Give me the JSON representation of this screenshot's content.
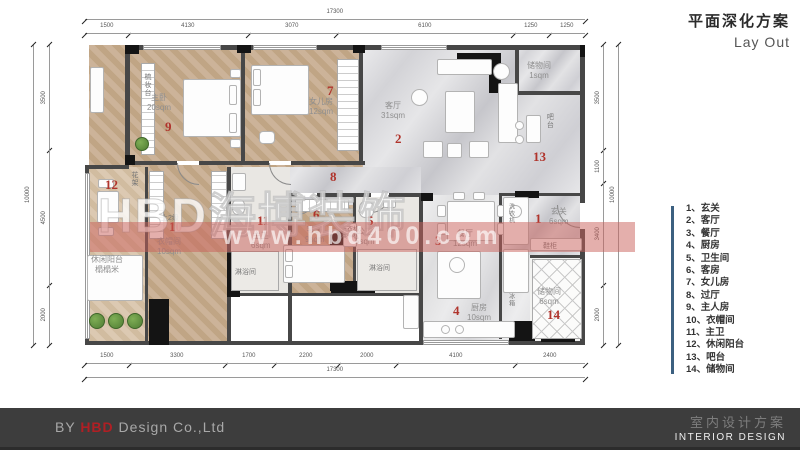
{
  "header": {
    "title_zh": "平面深化方案",
    "title_en": "Lay Out"
  },
  "legend": {
    "bar_color": "#3c6080",
    "items": [
      {
        "no": "1、",
        "label": "玄关"
      },
      {
        "no": "2、",
        "label": "客厅"
      },
      {
        "no": "3、",
        "label": "餐厅"
      },
      {
        "no": "4、",
        "label": "厨房"
      },
      {
        "no": "5、",
        "label": "卫生间"
      },
      {
        "no": "6、",
        "label": "客房"
      },
      {
        "no": "7、",
        "label": "女儿房"
      },
      {
        "no": "8、",
        "label": "过厅"
      },
      {
        "no": "9、",
        "label": "主人房"
      },
      {
        "no": "10、",
        "label": "衣帽间"
      },
      {
        "no": "11、",
        "label": "主卫"
      },
      {
        "no": "12、",
        "label": "休闲阳台"
      },
      {
        "no": "13、",
        "label": "吧台"
      },
      {
        "no": "14、",
        "label": "储物间"
      }
    ]
  },
  "rooms": {
    "r1": {
      "num": "1",
      "name": "玄关",
      "area": "6sqm"
    },
    "r2": {
      "num": "2",
      "name": "客厅",
      "area": "31sqm"
    },
    "r3": {
      "num": "3",
      "name": "餐厅",
      "area": "12sqm"
    },
    "r4": {
      "num": "4",
      "name": "厨房",
      "area": "10sqm"
    },
    "r5": {
      "num": "5",
      "name": "公卫",
      "area": "5sqm"
    },
    "r6": {
      "num": "6",
      "name": "客房",
      "area": "9sqm"
    },
    "r7": {
      "num": "7",
      "name": "女儿房",
      "area": "12sqm"
    },
    "r8": {
      "num": "8"
    },
    "r9": {
      "num": "9",
      "name": "主卧",
      "area": "20sqm"
    },
    "r10": {
      "num": "10",
      "name": "衣帽间",
      "area": "10sqm"
    },
    "r11": {
      "num": "11",
      "name": "主卫",
      "area": "6sqm"
    },
    "r12": {
      "num": "12",
      "name": "休闲阳台",
      "sub": "榻榻米"
    },
    "r13": {
      "num": "13",
      "name": "吧台"
    },
    "r14": {
      "num": "14",
      "name": "储物间",
      "area": "6sqm"
    },
    "storage_top": {
      "name": "储物间",
      "area": "1sqm"
    }
  },
  "labels": {
    "dresser": "梳妆台",
    "flower_rack": "花架",
    "steps": "上2级",
    "shoe_cabinet": "鞋柜",
    "shower1": "淋浴间",
    "shower2": "淋浴间",
    "washer": "洗衣机",
    "fridge": "冰箱",
    "laundry1": "洗衣机",
    "laundry2": "烘干机"
  },
  "dims": {
    "top_total": [
      17300
    ],
    "top": [
      1500,
      4130,
      3070,
      6100,
      1250,
      1250
    ],
    "bottom": [
      1500,
      3300,
      1700,
      2200,
      2000,
      4100,
      2400
    ],
    "bottom_total": [
      17300
    ],
    "left_total": [
      10000
    ],
    "left": [
      3500,
      4500,
      2000
    ],
    "right": [
      3500,
      1100,
      3400,
      2000
    ],
    "right_total": [
      10000
    ]
  },
  "watermark": {
    "brand": "HBD海博装饰",
    "url": "www.hbd400.com",
    "band_color": "#c9605a"
  },
  "footer": {
    "by": "BY ",
    "brand": "HBD",
    "company": " Design Co.,Ltd",
    "title_zh": "室内设计方案",
    "title_en": "INTERIOR DESIGN",
    "bar_color": "#3d3d3d",
    "brand_color": "#b01f24"
  },
  "colors": {
    "room_number": "#b0342c"
  }
}
